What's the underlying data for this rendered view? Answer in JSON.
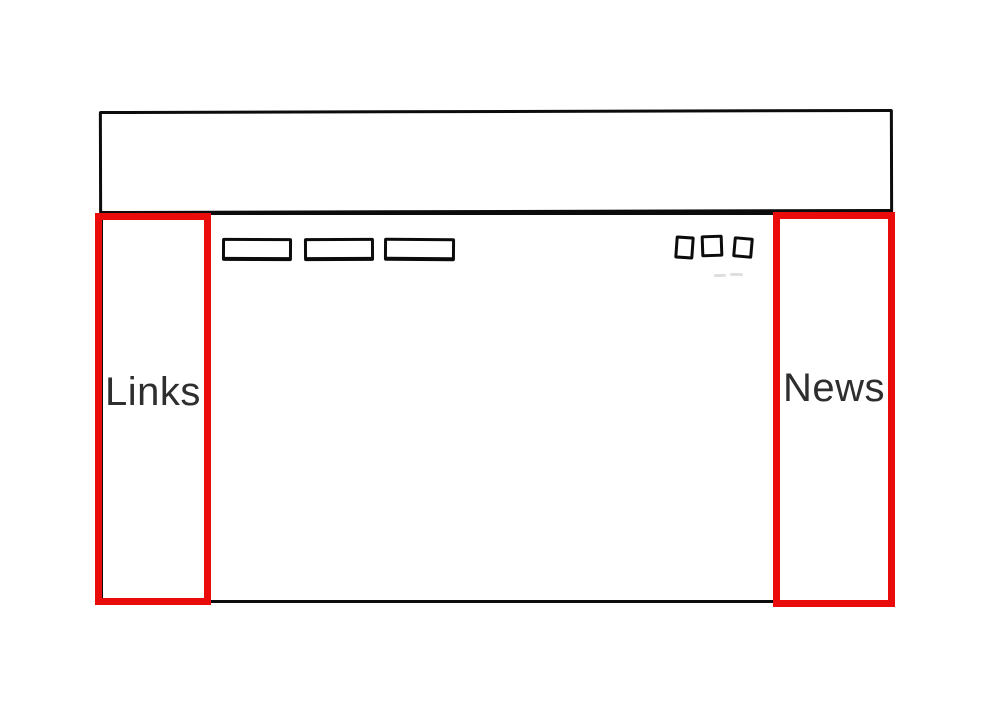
{
  "canvas": {
    "background": "#ffffff",
    "width": 1000,
    "height": 713
  },
  "colors": {
    "ink": "#0c0c0c",
    "annotation_red": "#ea0b0b",
    "label_text": "#2e2e2e",
    "smudge": "#dcdcdc"
  },
  "wireframe": {
    "header_box": "empty rectangle",
    "content_box": "empty rectangle",
    "nav_button_count": 3,
    "toolbar_square_count": 3,
    "sidebar_left": {
      "label": "Links"
    },
    "sidebar_right": {
      "label": "News"
    }
  }
}
